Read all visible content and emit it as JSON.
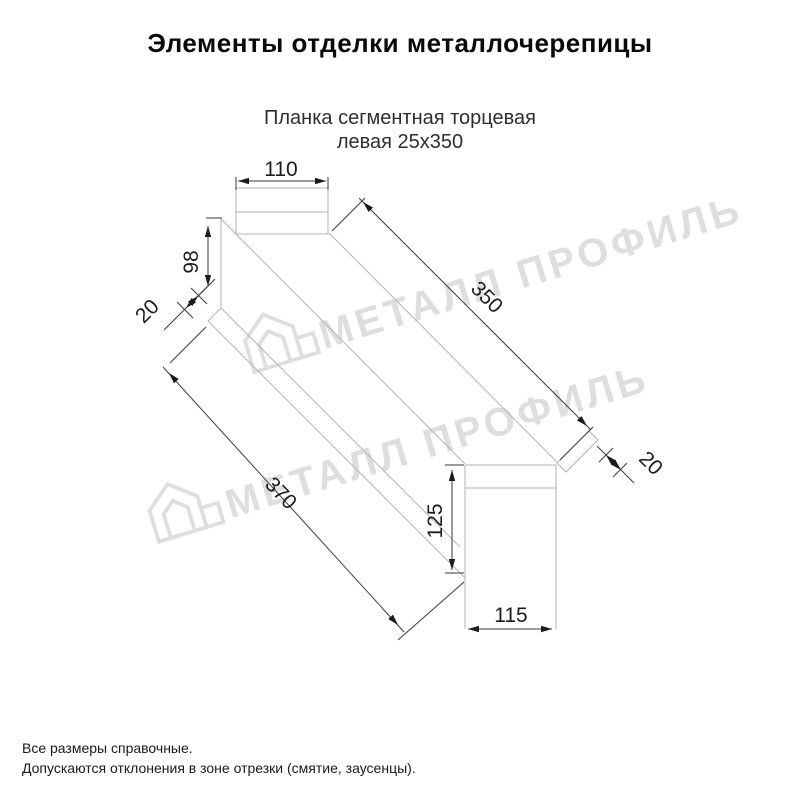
{
  "header": {
    "title": "Элементы отделки металлочерепицы"
  },
  "product": {
    "name_line1": "Планка сегментная торцевая",
    "name_line2": "левая 25х350"
  },
  "drawing": {
    "dimensions": {
      "top_flange_width": "110",
      "near_end_height": "98",
      "near_fold": "20",
      "top_edge_length": "350",
      "bottom_edge_length": "370",
      "far_fold": "20",
      "far_end_height": "125",
      "far_end_width": "115"
    },
    "watermark_text": "МЕТАЛЛ ПРОФИЛЬ"
  },
  "footer": {
    "note1": "Все размеры справочные.",
    "note2": "Допускаются отклонения в зоне отрезки (смятие, заусенцы)."
  },
  "colors": {
    "outline": "#b3b3b3",
    "dimension": "#1c1c1c",
    "watermark": "#dedede",
    "text": "#111111"
  }
}
